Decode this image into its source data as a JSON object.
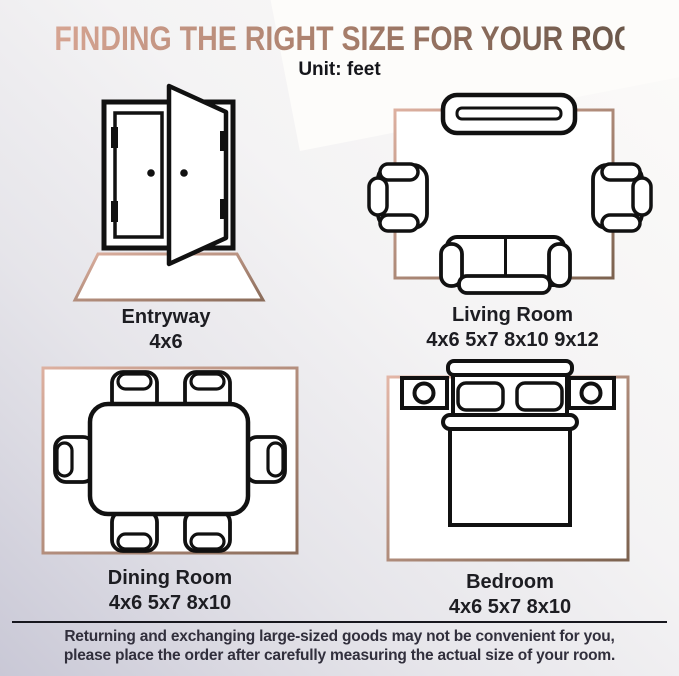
{
  "title": "FINDING THE RIGHT SIZE FOR YOUR ROOM",
  "subtitle": "Unit: feet",
  "unit": "feet",
  "rooms": [
    {
      "label": "Entryway",
      "sizes": "4x6",
      "icon": "double-door-icon"
    },
    {
      "label": "Living Room",
      "sizes": "4x6 5x7 8x10 9x12",
      "icon": "living-room-layout-icon"
    },
    {
      "label": "Dining Room",
      "sizes": "4x6 5x7 8x10",
      "icon": "dining-table-icon"
    },
    {
      "label": "Bedroom",
      "sizes": "4x6 5x7 8x10",
      "icon": "bed-icon"
    }
  ],
  "footer": {
    "line1": "Returning and exchanging large-sized goods may not be convenient for you,",
    "line2": "please place the order after carefully measuring the actual size of your room."
  },
  "colors": {
    "title_gradient_start": "#d6a492",
    "title_gradient_mid": "#a87e6b",
    "title_gradient_end": "#6b574a",
    "rug_gradient_start": "#ddb0a0",
    "rug_gradient_end": "#8a6c5a",
    "line_color": "#111111",
    "background_top_right": "#fcfbf9",
    "background_bottom_left": "#c9c8d6",
    "text_color": "#1d1d22"
  }
}
